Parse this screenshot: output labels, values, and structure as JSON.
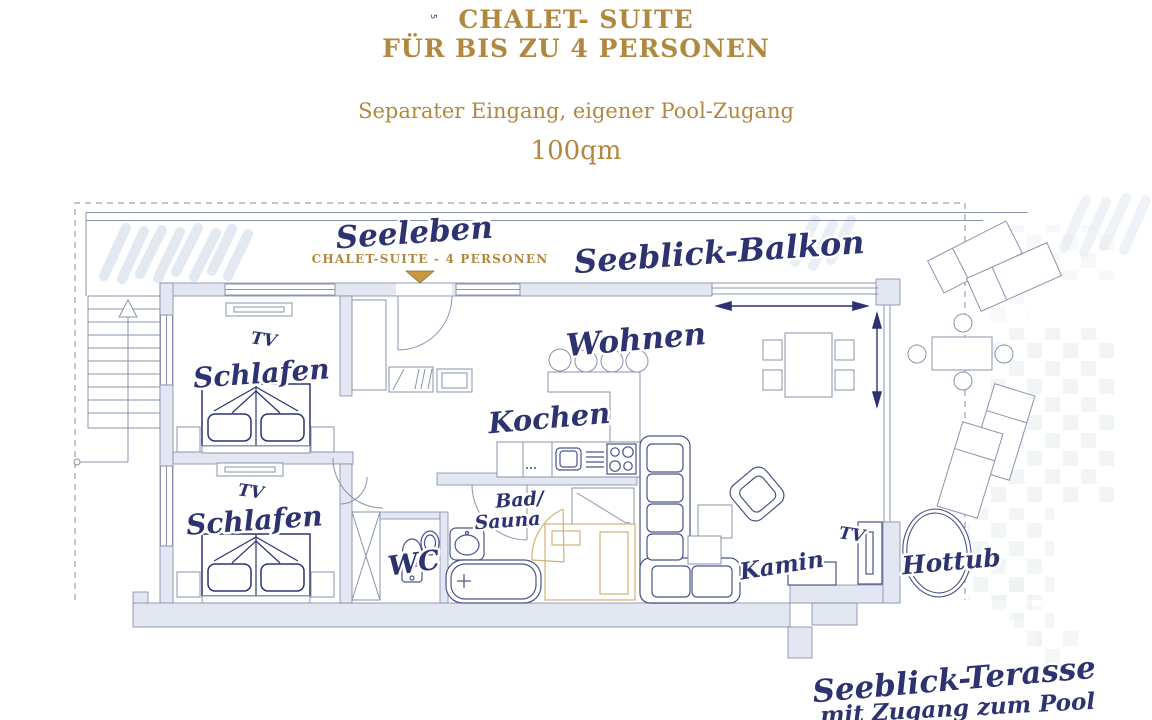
{
  "header": {
    "title_line1": "CHALET-  SUITE",
    "title_line2": "FÜR BIS ZU 4 PERSONEN",
    "subtitle": "Separater Eingang, eigener Pool-Zugang",
    "area": "100qm",
    "tiny_note": "5"
  },
  "plan": {
    "unit_name": "Seeleben",
    "unit_subtitle": "CHALET-SUITE - 4 PERSONEN",
    "balcony_label": "Seeblick-Balkon",
    "bedroom1": {
      "label": "Schlafen",
      "tv": "TV"
    },
    "bedroom2": {
      "label": "Schlafen",
      "tv": "TV"
    },
    "living": {
      "label": "Wohnen",
      "tv": "TV",
      "fireplace": "Kamin"
    },
    "kitchen": {
      "label": "Kochen"
    },
    "bath": {
      "label_line1": "Bad/",
      "label_line2": "Sauna"
    },
    "wc": {
      "label": "WC"
    },
    "hottub": {
      "label": "Hottub"
    },
    "terrace": {
      "label": "Seeblick-Terasse",
      "sublabel": "mit Zugang zum Pool"
    }
  },
  "colors": {
    "gold": "#b1883f",
    "navy": "#2c3370",
    "wall": "#e2e7f2",
    "wallstroke": "#7f88ad",
    "lite": "#8a93ae",
    "furn": "#49538a",
    "hatch": "#e3e9f1",
    "checker": "#e6edee",
    "sauna": "#d3b176",
    "dash": "#9aa0b4"
  }
}
